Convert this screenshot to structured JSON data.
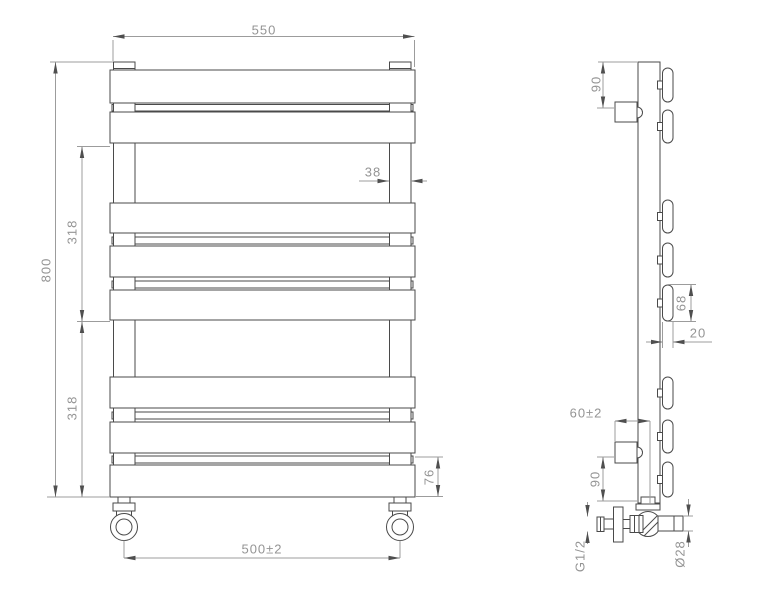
{
  "drawing": {
    "front_view": {
      "dimensions": {
        "overall_width": "550",
        "overall_height": "800",
        "upper_section_height": "318",
        "lower_section_height": "318",
        "tube_width": "38",
        "bottom_section_height": "76",
        "valve_centres_width": "500±2"
      }
    },
    "side_view": {
      "dimensions": {
        "top_bracket_offset": "90",
        "panel_face_height": "68",
        "panel_thickness": "20",
        "wall_to_pipe_centre": "60±2",
        "bottom_bracket_offset": "90",
        "connection_thread": "G1/2",
        "valve_diameter": "Ø28"
      }
    }
  }
}
